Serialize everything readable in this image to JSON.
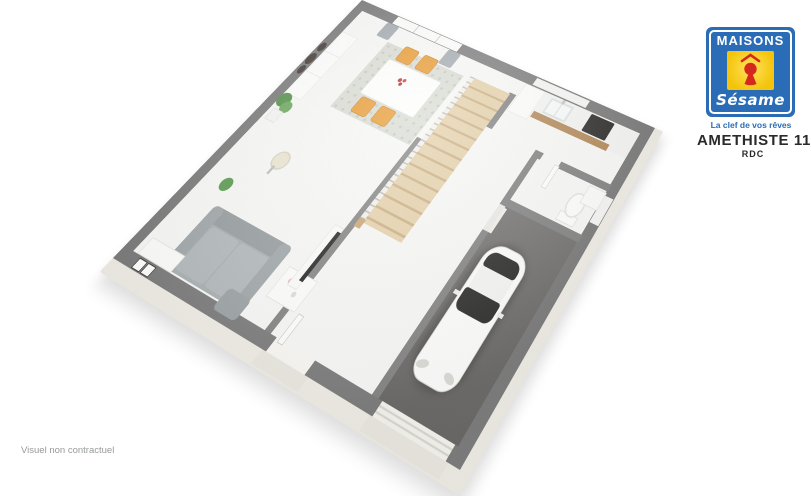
{
  "branding": {
    "logo_title": "MAISONS",
    "logo_subtitle": "Sésame",
    "tagline": "La clef de vos rêves",
    "colors": {
      "blue": "#2a6cb5",
      "yellow": "#f5c40b",
      "red": "#d5291d"
    }
  },
  "plan": {
    "model_name": "AMETHISTE 110 GI",
    "level": "RDC"
  },
  "footer": {
    "disclaimer": "Visuel non contractuel"
  },
  "scene": {
    "type": "3d-floor-plan-render",
    "palette": {
      "wall_gray": "#7a7a7a",
      "partition_gray": "#828282",
      "floor_white": "#f6f6f4",
      "slab_cream": "#edebe3",
      "garage_floor": "#6e6c6a",
      "stair_wood": "#d9c09a",
      "chair_orange": "#e6992f",
      "sofa_gray": "#a8aeb0",
      "car_glass": "#2c2c2a"
    },
    "elements": [
      "sofa",
      "coffee-table",
      "pouf",
      "tv",
      "sideboard",
      "wall-mirrors",
      "dining-table",
      "dining-chairs",
      "rug",
      "staircase",
      "kitchen-counter",
      "sink",
      "cooktop",
      "wc-toilet",
      "washbasin",
      "garage",
      "car",
      "entrance-door",
      "garage-door",
      "bay-window",
      "curtains",
      "plants",
      "floor-lamp",
      "console"
    ]
  }
}
